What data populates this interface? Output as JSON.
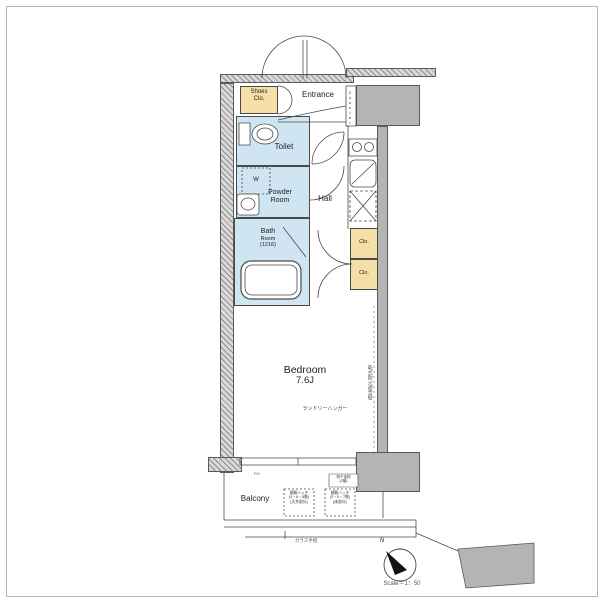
{
  "rooms": {
    "shoes_closet": {
      "l1": "Shoes",
      "l2": "Clo."
    },
    "entrance": "Entrance",
    "counter": "Counter",
    "toilet": "Toilet",
    "washer": "W",
    "powder": {
      "l1": "Powder",
      "l2": "Room"
    },
    "hall": "Hall",
    "bath": {
      "l1": "Bath",
      "l2": "Room",
      "l3": "(1216)"
    },
    "closet_upper": "Clo.",
    "closet_lower": "Clo.",
    "bedroom": {
      "name": "Bedroom",
      "size": "7.6J"
    },
    "balcony": "Balcony"
  },
  "annotations": {
    "laundry_hanger": "ランドリーハンガー",
    "party_wall": "乾式耐火遮音壁",
    "escape_hatch_left": {
      "l1": "避難ハッチ",
      "l2": "(4・6・8階)",
      "l3": "(天井部分)"
    },
    "escape_hatch_right": {
      "l1": "避難ハッチ",
      "l2": "(3・5・7階)",
      "l3": "(床部分)"
    },
    "corner_note": {
      "l1": "物干金物",
      "l2": "(2階)"
    },
    "fix_window": "FIX",
    "glass_rail": "ガラス手摺"
  },
  "compass": {
    "north_label": "N",
    "scale_label": "Scale＝1：50"
  },
  "colors": {
    "wet_area": "#cfe5f2",
    "closet": "#f5dfa6",
    "wall": "#b4b4b4",
    "line": "#4a4a4a"
  }
}
